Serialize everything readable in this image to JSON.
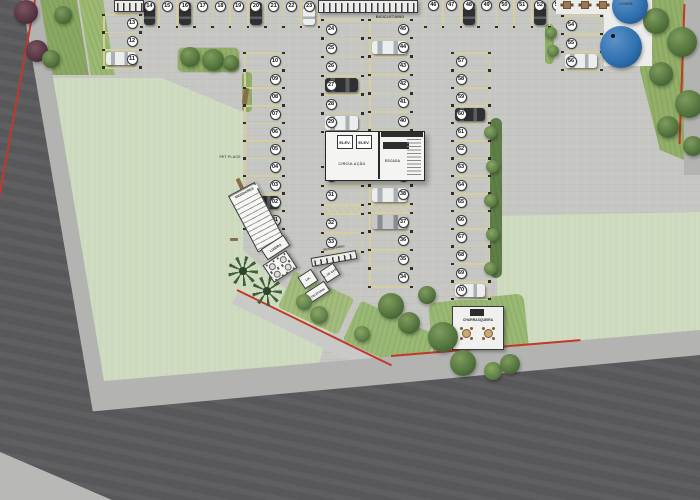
{
  "labels": {
    "bicicletario_top": "BICICLETÁRIO",
    "bicicletario_mid": "BICICLETÁRIO",
    "medidores": "MEDIDORES",
    "pet_place": "PET PLACE",
    "lixeira": "LIXEIRA",
    "lix": "LIX.",
    "gas": "L. DE GÁS",
    "telefonia": "TELEFONIA",
    "churrasqueira": "CHURRASQUEIRA",
    "lounge": "LOUNGE",
    "elev_1": "ELEV.",
    "elev_2": "ELEV.",
    "circulacao": "CIRCULAÇÃO",
    "escada": "ESCADA"
  },
  "parking_groups": [
    {
      "id": "col-west",
      "numbers": [
        "13",
        "12",
        "11"
      ],
      "cars": {
        "11": "white"
      }
    },
    {
      "id": "row-top-left",
      "numbers": [
        "14",
        "15",
        "16",
        "17",
        "18",
        "19",
        "20",
        "21",
        "22",
        "23"
      ],
      "cars": {
        "14": "dark",
        "16": "dark",
        "20": "dark",
        "23": "white"
      }
    },
    {
      "id": "col-inner-west",
      "numbers": [
        "10",
        "09",
        "08",
        "07",
        "06",
        "05",
        "04",
        "03",
        "02",
        "01"
      ],
      "cars": {
        "02": "dark"
      }
    },
    {
      "id": "col-center-left-upper",
      "numbers": [
        "24",
        "25",
        "26",
        "27",
        "28",
        "29"
      ],
      "cars": {
        "27": "dark",
        "29": "white"
      }
    },
    {
      "id": "col-center-right-upper",
      "numbers": [
        "45",
        "44",
        "43",
        "42",
        "41",
        "40"
      ],
      "cars": {
        "44": "white"
      }
    },
    {
      "id": "col-center-left-lower",
      "numbers": [
        "30",
        "31",
        "32",
        "33"
      ],
      "cars": {}
    },
    {
      "id": "col-center-right-lower",
      "numbers": [
        "39",
        "38",
        "37",
        "36",
        "35",
        "34"
      ],
      "cars": {
        "38": "white",
        "37": "silver"
      }
    },
    {
      "id": "row-top-right",
      "numbers": [
        "46",
        "47",
        "48",
        "49",
        "50",
        "51",
        "52",
        "53"
      ],
      "cars": {
        "48": "dark",
        "52": "dark"
      }
    },
    {
      "id": "col-east-short",
      "numbers": [
        "54",
        "55",
        "56"
      ],
      "cars": {
        "56": "white"
      }
    },
    {
      "id": "col-east",
      "numbers": [
        "57",
        "58",
        "59",
        "60",
        "61",
        "62",
        "63",
        "64",
        "65",
        "66",
        "67",
        "68",
        "69",
        "70"
      ],
      "cars": {
        "60": "dark",
        "70": "white"
      }
    }
  ],
  "colors": {
    "pavement": "#c6c6c3",
    "road": "#58585a",
    "sidewalk": "#b3b3b1",
    "lawn": "#cdd9bc",
    "grass": "#93b069",
    "line_yellow": "#d8cf9e",
    "boundary_red": "#c0392b",
    "umbrella_blue": "#2e6fae",
    "building_fill": "#f4f4f2",
    "table_brown": "#9a7a52"
  }
}
